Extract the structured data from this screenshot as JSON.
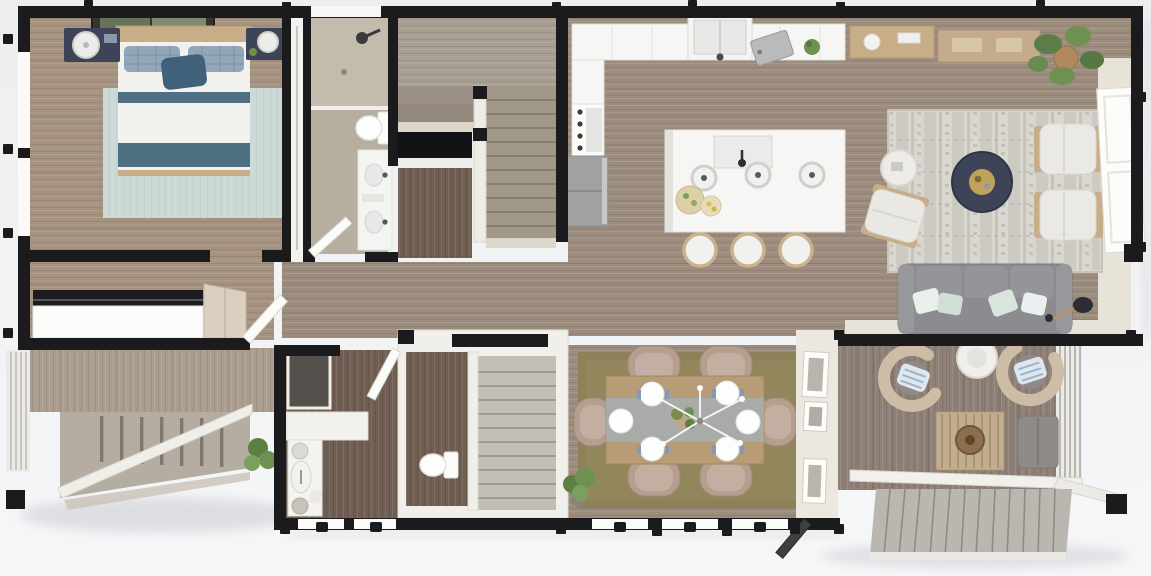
{
  "meta": {
    "title": "3D rendered floor plan, single level, top-down view",
    "view": "top-down 3D architectural render",
    "text_labels_visible": "none"
  },
  "palette": {
    "bg": "#eef0f2",
    "wall": "#1b1b1d",
    "wallWhite": "#f1efeb",
    "floorMain": "#9c8c7d",
    "floorBedroom": "#a5927f",
    "floorBath": "#b6af9f",
    "floorDark": "#6f5e51",
    "floorDeck": "#8e8076",
    "floorPorch": "#ab9d8d",
    "stairTread": "#a29889",
    "rugBedroom": "#ccd9d6",
    "rugLiving": "#dad7d1",
    "rugDining": "#8d8159",
    "counter": "#f6f6f4",
    "sofa": "#8b8b90",
    "navy": "#3d4457",
    "wood": "#c8ad89",
    "chairTan": "#b59e8e",
    "accentBlue": "#4f6f83",
    "green": "#6f9150",
    "cream": "#e7e3d9"
  },
  "rooms": {
    "bedroom": {
      "label": "Primary bedroom with double bed, blue striped bedding, two navy nightstands with white lamps, wall art and pale mint rug"
    },
    "closet": {
      "label": "Reach-in closet between bedroom and bathroom"
    },
    "bathroom": {
      "label": "Bathroom with walk-in shower, toilet and double vanity"
    },
    "stairwell": {
      "label": "Central staircase with upper landing, railing and lower flight"
    },
    "kitchen": {
      "label": "Kitchen with L-shaped counter, sink under window, range, refrigerator and island with prep sink, three pendant lights and three barstools"
    },
    "living": {
      "label": "Living room with consoles, fiddle-leaf fig, patterned rug, navy round coffee table, three white armchairs, gray sofa with pillows, floor lamp and large white door"
    },
    "entry": {
      "label": "Entry hall with picture window bench, coat closet and open front door"
    },
    "mudroom": {
      "label": "Mudroom / powder room with vanity, vessel sink and separate water closet"
    },
    "dining": {
      "label": "Dining area with wood table for six, runner, place settings, chandelier, plant and gallery frames"
    },
    "deck": {
      "label": "Rear deck with two swivel chairs, side table, slatted coffee table, ottoman, privacy screen and wide stairs"
    },
    "porch": {
      "label": "Front porch with railing, balusters and steps"
    }
  },
  "counts": {
    "dining_chairs": 6,
    "island_stools": 3,
    "pendant_lights": 3,
    "living_armchairs": 3,
    "deck_swivel_chairs": 2,
    "sofa_seats": 3
  }
}
